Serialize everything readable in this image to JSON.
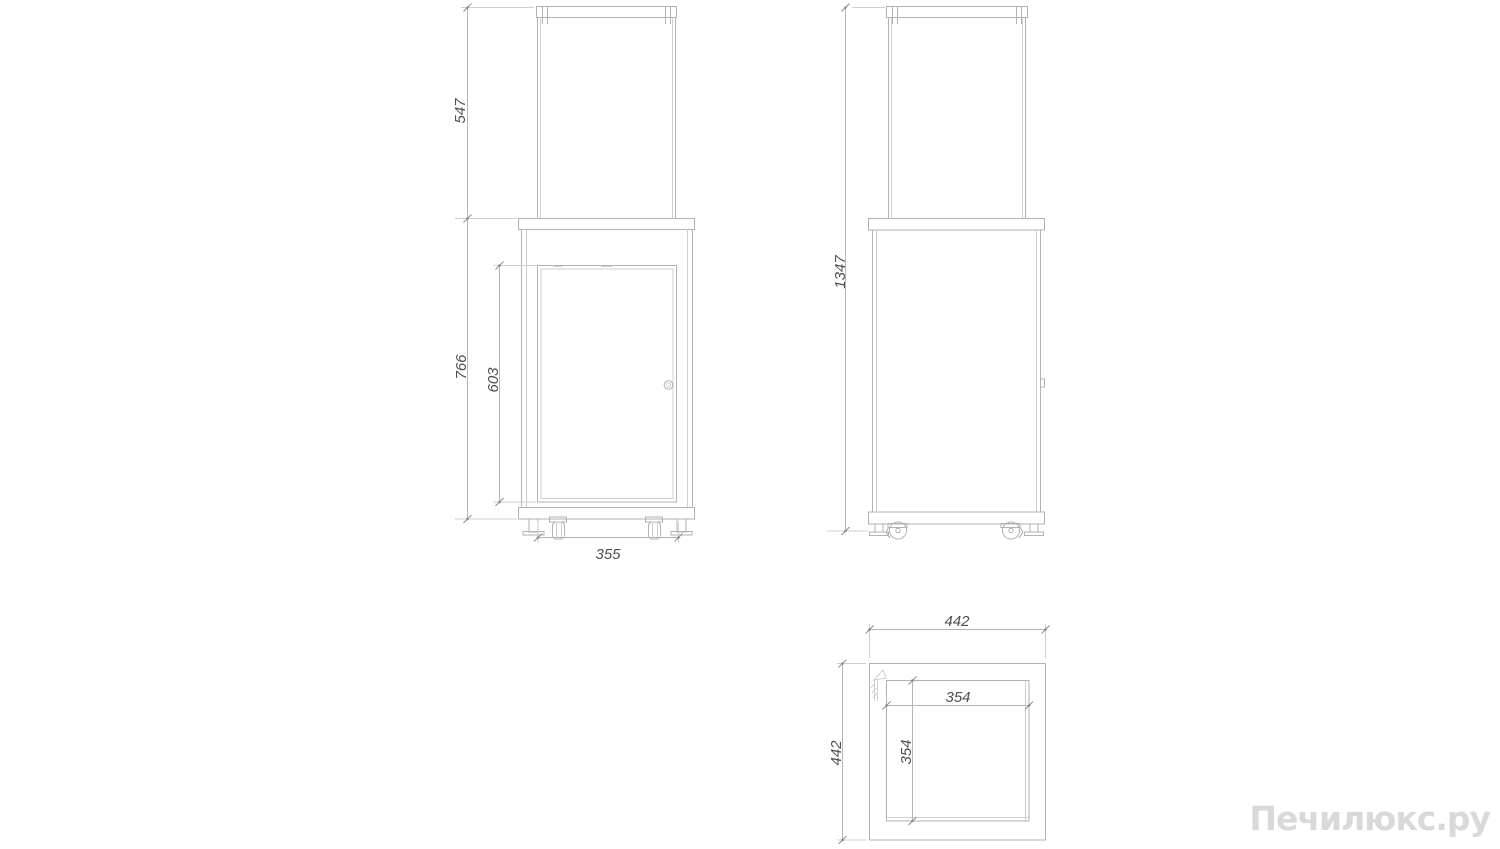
{
  "watermark": "Печилюкс.ру",
  "drawing": {
    "type": "technical-three-view",
    "front_view": {
      "glass_height": "547",
      "body_height": "766",
      "door_height": "603",
      "base_width": "355"
    },
    "side_view": {
      "total_height": "1347"
    },
    "top_view": {
      "outer_width": "442",
      "outer_depth": "442",
      "inner_width": "354",
      "inner_depth": "354"
    }
  },
  "colors": {
    "line": "#b2b2b2",
    "line_light": "#cfcfcf",
    "dim_text": "#4f4f4f",
    "tick": "#8c8c8c",
    "watermark": "#d9d9d9",
    "background": "#ffffff"
  }
}
